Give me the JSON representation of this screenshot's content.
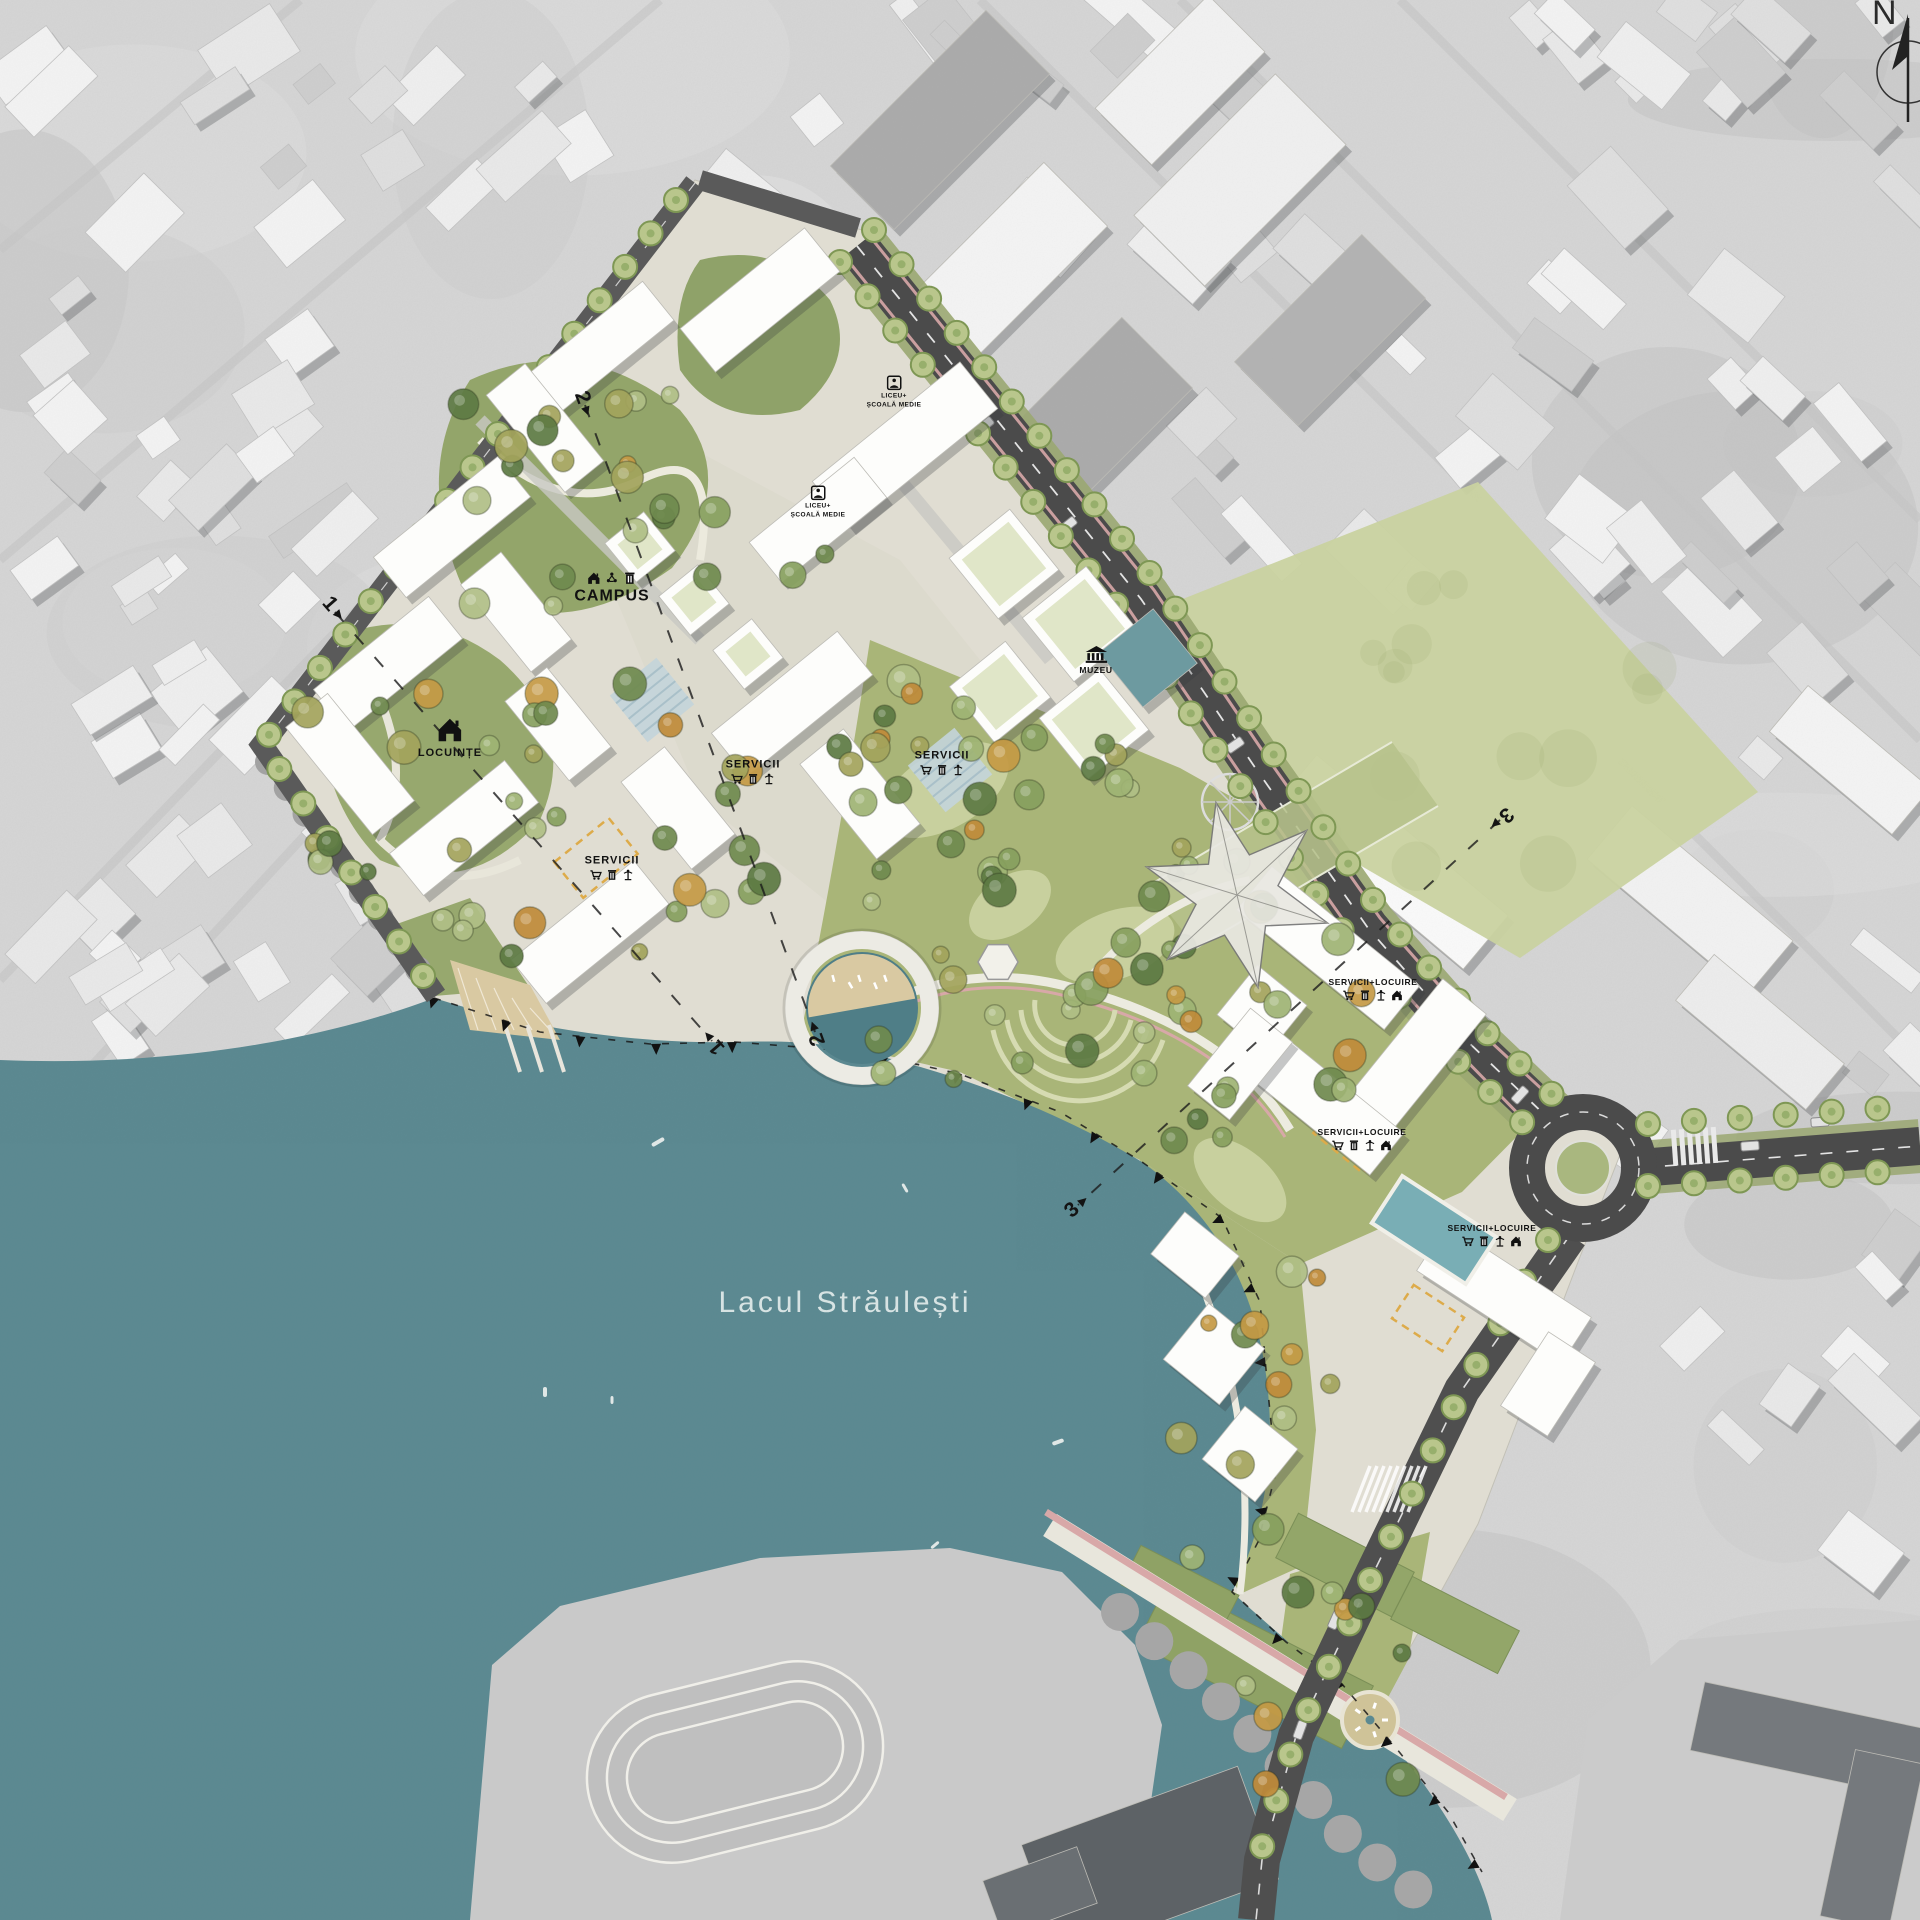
{
  "labels": {
    "lake": "Lacul Străulești",
    "campus": "CAMPUS",
    "locuinte": "LOCUINȚE",
    "servicii": "SERVICII",
    "servicii_locuire": "SERVICII+LOCUIRE",
    "muzeu": "MUZEU",
    "liceu_line1": "LICEU+",
    "liceu_line2": "ȘCOALĂ MEDIE"
  },
  "markers": {
    "s1": "1",
    "s2": "2",
    "s3": "3"
  },
  "compass": {
    "north": "N"
  },
  "icons": {
    "house": "house-icon",
    "cart": "shopping-cart-icon",
    "shop": "kiosk-icon",
    "fountain": "fountain-icon",
    "recycle": "recycle-icon",
    "museum": "museum-icon",
    "reader": "school-icon",
    "north": "north-arrow-icon",
    "section": "section-arrow-icon"
  },
  "colors": {
    "water": "#5b8991",
    "site_ground": "#e0ddd2",
    "plaza": "#dcd9cc",
    "park_green": "#a9b578",
    "field_green": "#c9d2a0",
    "road": "#4b4b4b",
    "building": "#fdfdfb",
    "teal_building": "#6d9aa0",
    "pool": "#79aeb5",
    "bike_lane": "#d8a8a8",
    "tree_accent": "#c59a45",
    "lake_label": "#d7e3e3"
  }
}
